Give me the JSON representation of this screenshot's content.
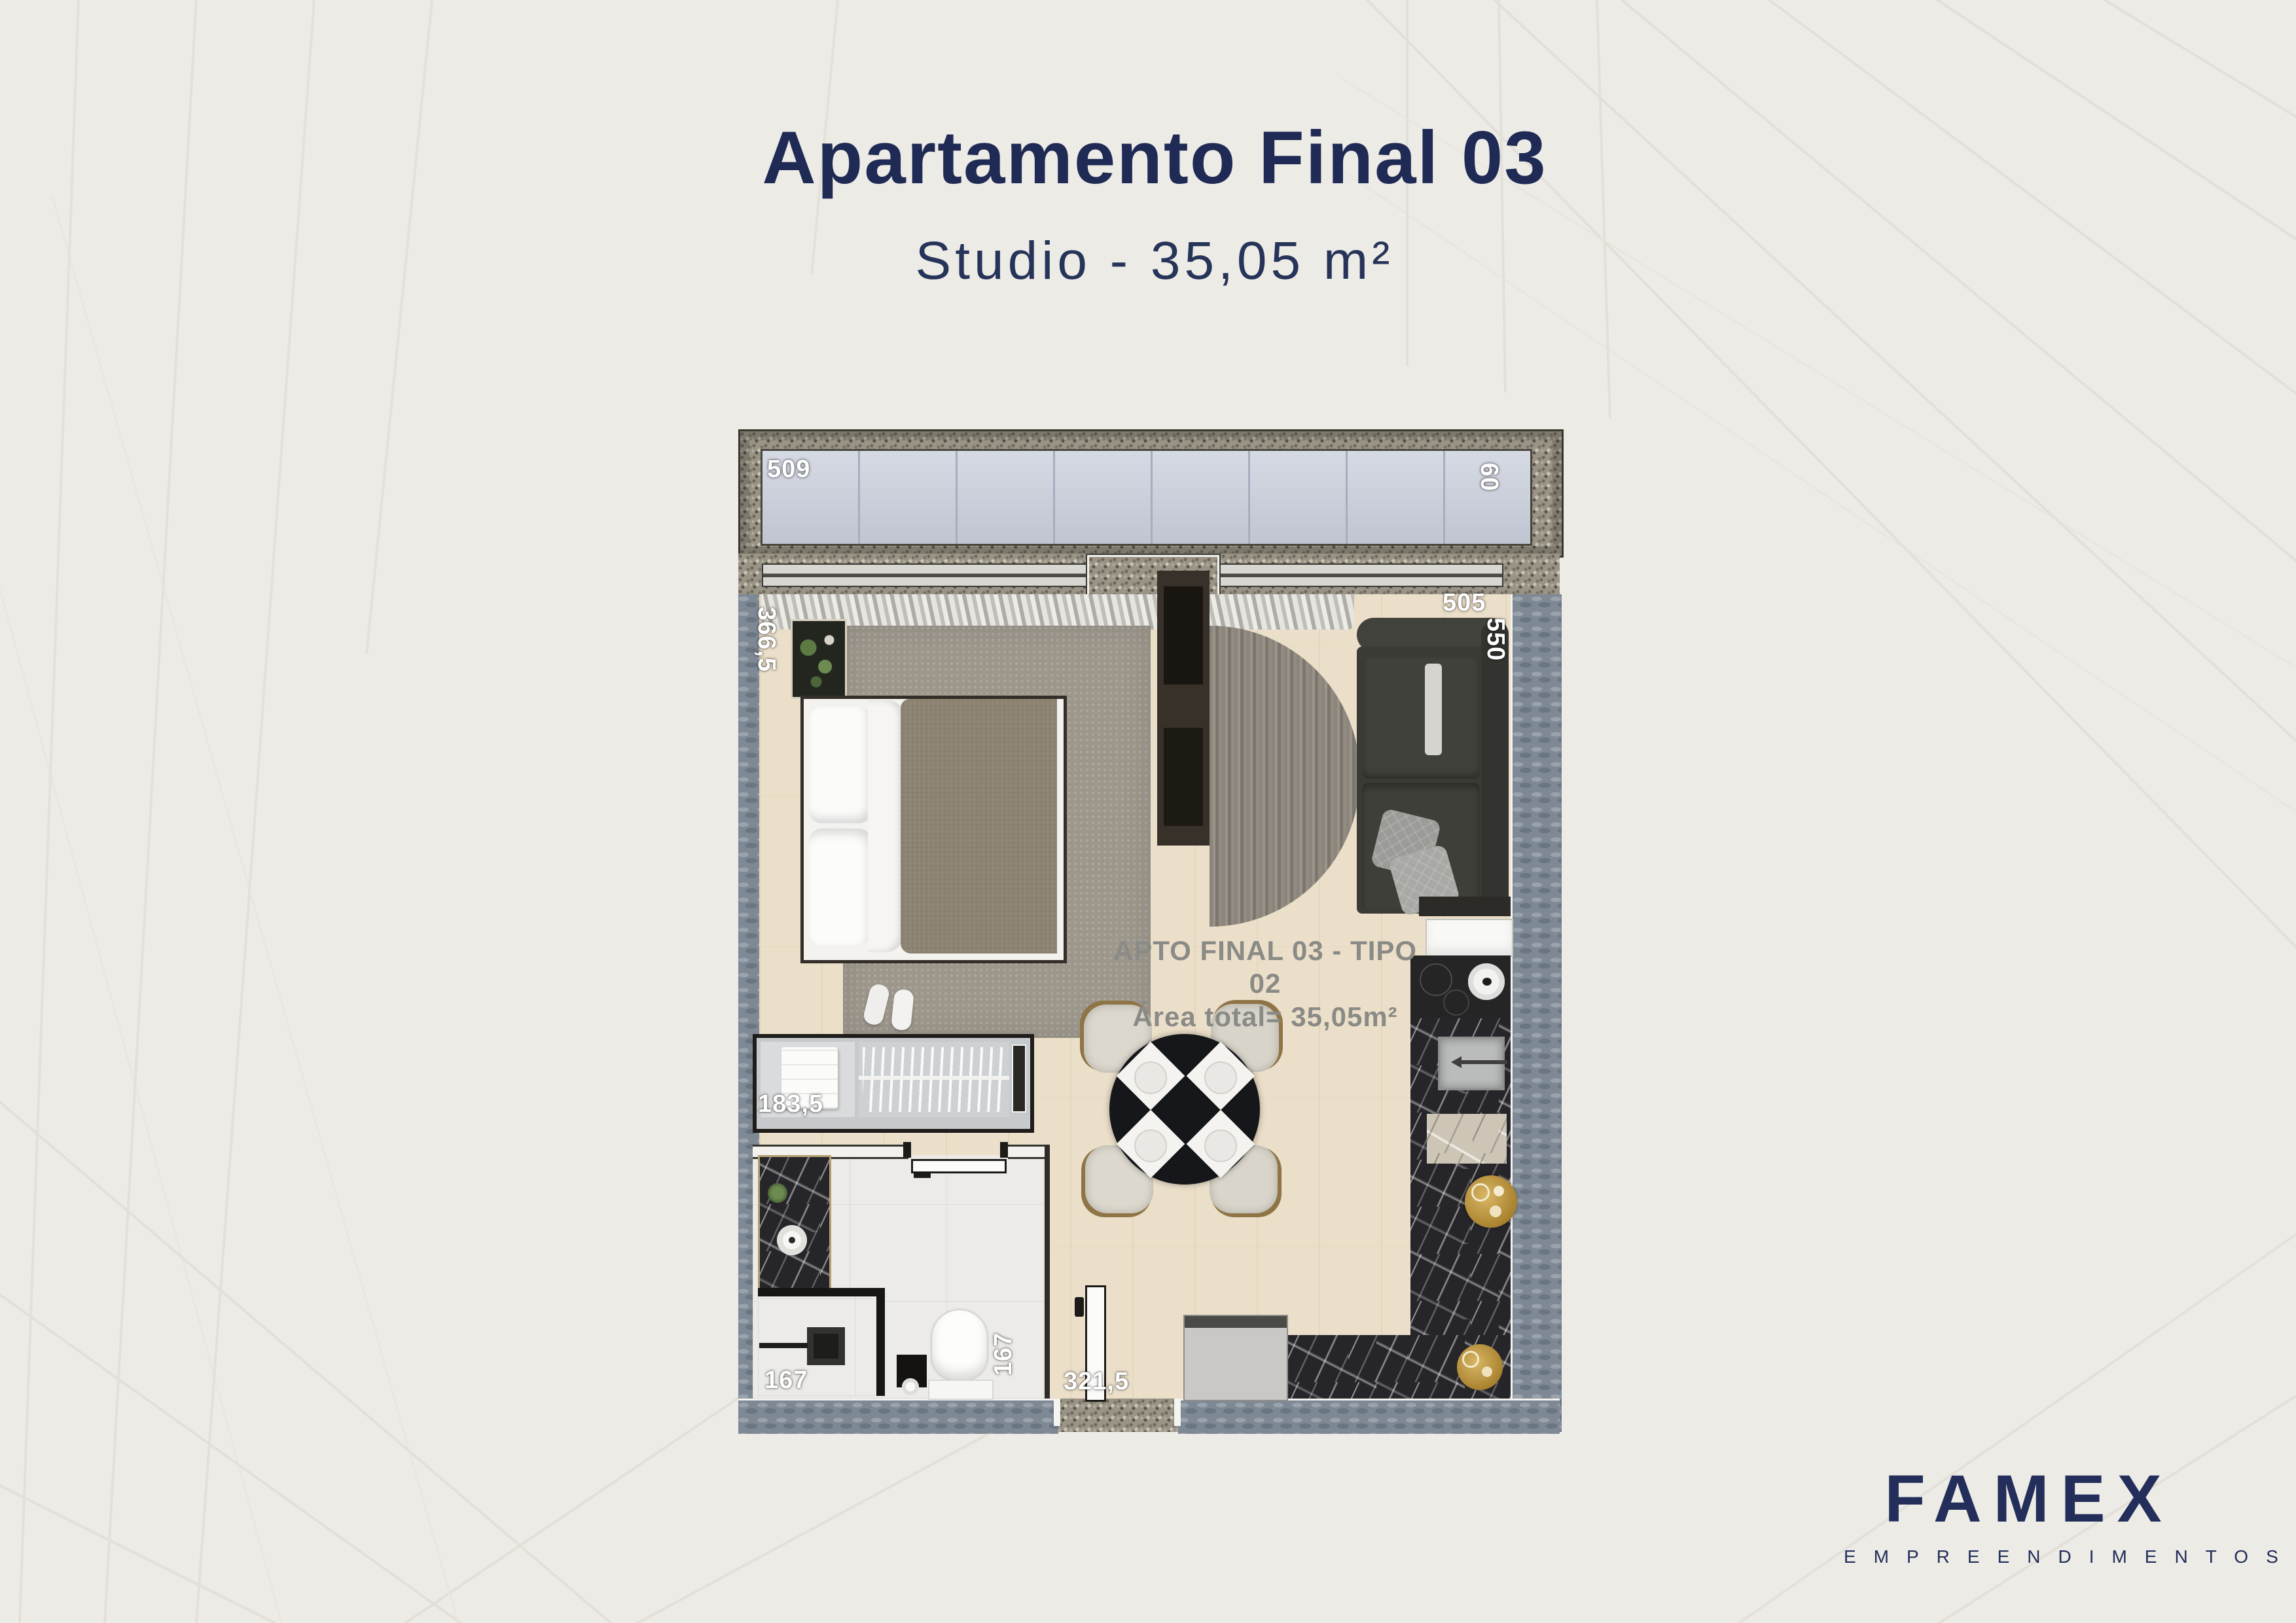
{
  "header": {
    "title": "Apartamento Final 03",
    "subtitle": "Studio - 35,05 m²"
  },
  "floorplan": {
    "caption": {
      "line1": "APTO FINAL 03 - TIPO 02",
      "line2": "Área total= 35,05m²"
    },
    "dims": {
      "balcony_width": "509",
      "balcony_depth": "60",
      "bedroom_width": "366,5",
      "living_width": "505",
      "living_depth": "550",
      "closet_width": "183,5",
      "bathroom_width": "167",
      "bathroom_depth": "167",
      "entry_width": "321,5"
    }
  },
  "brand": {
    "name": "FAMEX",
    "tagline": "EMPREENDIMENTOS"
  },
  "colors": {
    "navy": "#1f2a55",
    "caption_grey": "#8a8a86",
    "dimension_white": "#ffffff",
    "balcony_glass": "#c8cdda",
    "wall_bluegrey": "#7e8995",
    "granite": "#9a9486",
    "wood_floor": "#ebdfc9",
    "counter_marble": "#26262a",
    "gold_decor": "#c19a4b",
    "background": "#edebe6"
  }
}
